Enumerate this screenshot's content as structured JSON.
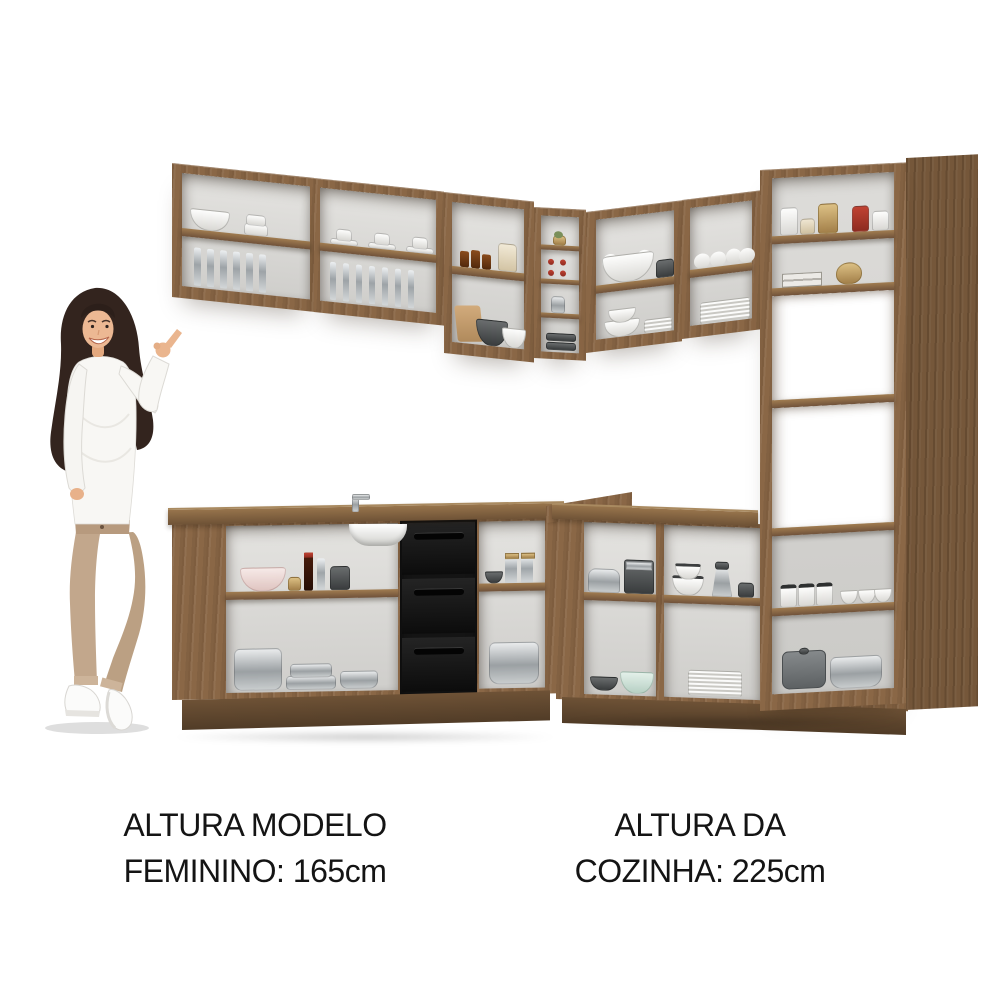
{
  "page": {
    "background_color": "#ffffff",
    "content": "L-shaped corner kitchen product photo with female model for height comparison"
  },
  "captions": {
    "model_height": {
      "line1": "ALTURA MODELO",
      "line2": "FEMININO: 165cm"
    },
    "kitchen_height": {
      "line1": "ALTURA DA",
      "line2": "COZINHA: 225cm"
    },
    "text_color": "#141414"
  },
  "palette": {
    "wood": "#8a6746",
    "wood_dark": "#75573a",
    "wood_shadow": "#5d4530",
    "interior": "#d9d8d4",
    "drawer_black": "#161616",
    "steel": "#aab0b3",
    "accent_red": "#b43527",
    "accent_gold": "#c2a066",
    "skin": "#eab58e",
    "hair": "#33241e",
    "sweater": "#f8f7f4",
    "trousers": "#c2a78c",
    "sneakers": "#fbfbfa"
  },
  "model": {
    "pose": "standing with legs crossed, right hand raised pointing at the kitchen, left hand in pocket",
    "outfit": [
      "white long-sleeve knit top",
      "beige high-waist trousers",
      "white sneakers"
    ]
  },
  "kitchen": {
    "layout": "L-shaped corner kitchen with open shelving, rustic brown wood finish",
    "wall_cabinets": [
      {
        "name": "wall-bay-1",
        "contents": [
          "white serving bowl",
          "stacked cups",
          "drinking glasses"
        ]
      },
      {
        "name": "wall-bay-2",
        "contents": [
          "cups with saucers",
          "drinking glasses"
        ]
      },
      {
        "name": "wall-bay-3",
        "contents": [
          "amber spice jars",
          "ceramic jar",
          "cutting board",
          "gray bowl stack",
          "white pot"
        ]
      },
      {
        "name": "corner-rack",
        "contents": [
          "potted plant",
          "wine bottles",
          "metal cup",
          "wine bottles"
        ]
      },
      {
        "name": "wall-bay-4",
        "contents": [
          "scalloped white bowl",
          "gray cup",
          "stacked white bowls",
          "plates"
        ]
      },
      {
        "name": "wall-bay-5",
        "contents": [
          "round white jars",
          "stacked plates"
        ]
      }
    ],
    "tall_cabinet": {
      "name": "tall-cabinet",
      "contents": [
        "kitchen canisters",
        "books",
        "brass kettle",
        "lidded white jars",
        "white bowls",
        "gray stockpot",
        "steel stockpot"
      ]
    },
    "base_cabinets": [
      {
        "name": "base-bay-1",
        "contents": [
          "rose bowl stack",
          "oil bottles",
          "gray canister",
          "stockpot with lid",
          "stacked pans",
          "casserole"
        ]
      },
      {
        "name": "sink-unit",
        "contents": [
          "undermount sink basin",
          "faucet"
        ]
      },
      {
        "name": "drawer-unit",
        "drawer_count": 3,
        "color": "#161616"
      },
      {
        "name": "base-bay-2",
        "contents": [
          "glass canisters with gold lids",
          "gray bowl",
          "steel stockpot"
        ]
      },
      {
        "name": "base-bay-3",
        "contents": [
          "toaster",
          "espresso machine",
          "white bowls",
          "box grater",
          "gray mug",
          "black bowl",
          "mint scalloped bowl",
          "stacked plates"
        ]
      }
    ]
  }
}
